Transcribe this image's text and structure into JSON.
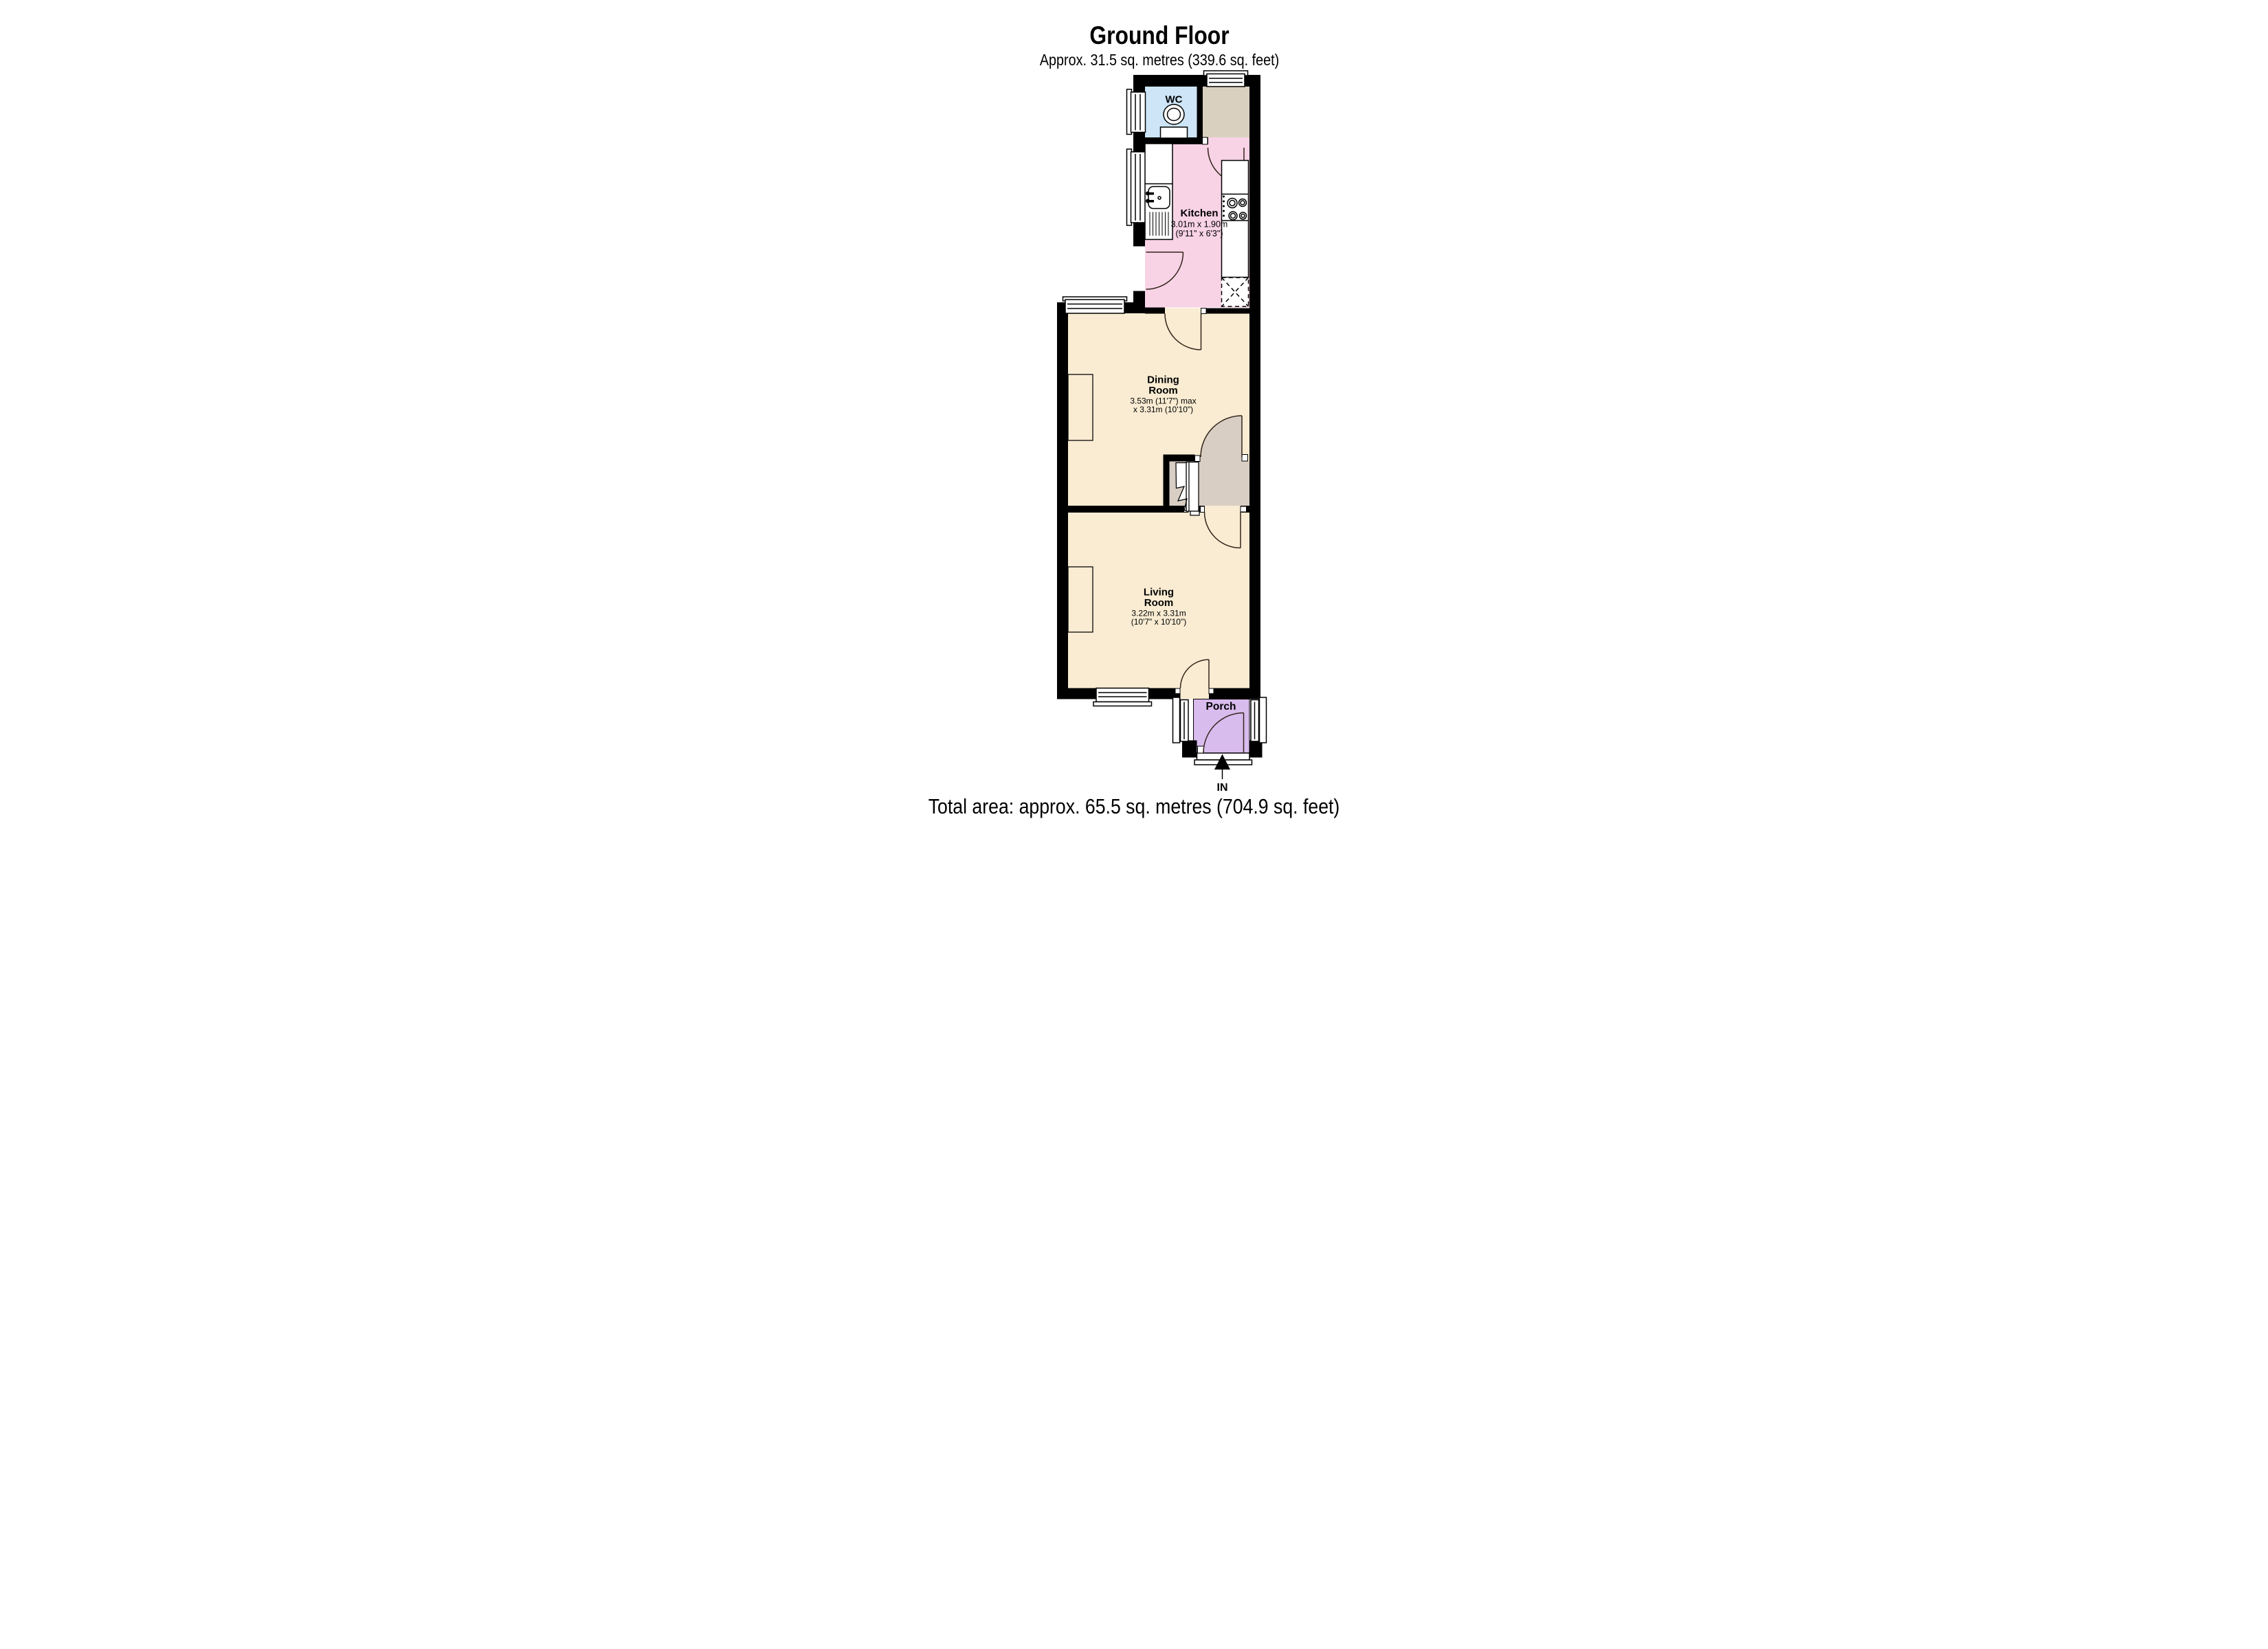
{
  "header": {
    "title": "Ground Floor",
    "subtitle": "Approx. 31.5 sq. metres (339.6 sq. feet)"
  },
  "footer": {
    "total_area": "Total area: approx. 65.5 sq. metres (704.9 sq. feet)"
  },
  "entrance": {
    "label": "IN"
  },
  "rooms": {
    "wc": {
      "name": "WC"
    },
    "kitchen": {
      "name": "Kitchen",
      "dim_metric": "3.01m x 1.90m",
      "dim_imperial": "(9'11\" x 6'3\")"
    },
    "dining": {
      "name_line1": "Dining",
      "name_line2": "Room",
      "dim_metric": "3.53m (11'7\") max",
      "dim_imperial": "x 3.31m (10'10\")"
    },
    "living": {
      "name_line1": "Living",
      "name_line2": "Room",
      "dim_metric": "3.22m x 3.31m",
      "dim_imperial": "(10'7\" x 10'10\")"
    },
    "porch": {
      "name": "Porch"
    }
  },
  "colors": {
    "wall": "#000000",
    "cream": "#F9ECD3",
    "pink": "#F8D3E6",
    "blue": "#CDE5F6",
    "tan": "#DAD0C0",
    "taupe": "#D8CEC3",
    "purple": "#D9BCEE",
    "door_arc": "#33241A",
    "fixture_line": "#000000"
  }
}
